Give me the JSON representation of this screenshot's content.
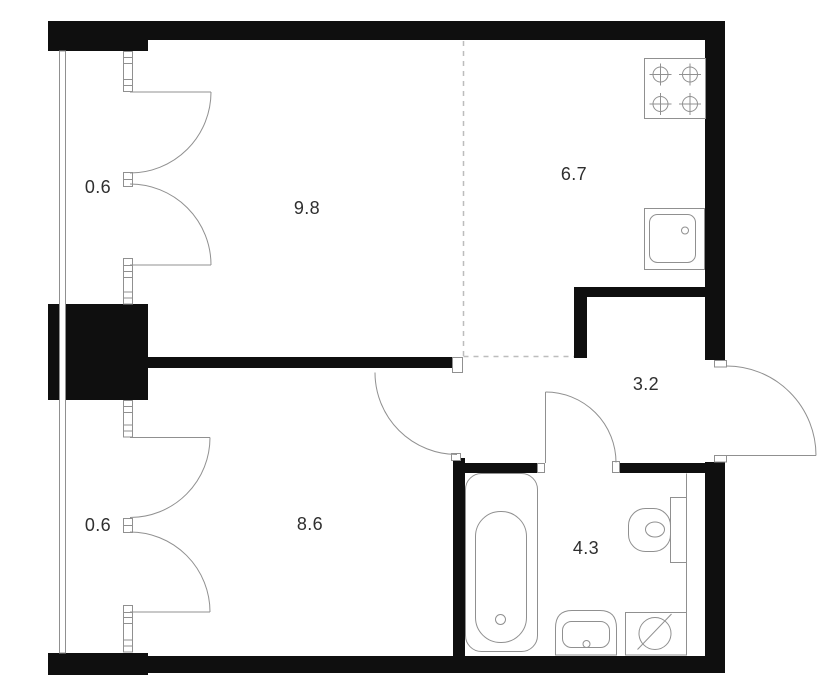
{
  "title": "Apartment floor plan",
  "colors": {
    "wall": "#0f0f0f",
    "line": "#909090",
    "dashed": "#bdbdbd",
    "label": "#2f2f2f",
    "background": "#ffffff"
  },
  "floorplan": {
    "type": "floor_plan",
    "rooms": [
      {
        "name": "living-room",
        "area": "9.8"
      },
      {
        "name": "kitchen",
        "area": "6.7"
      },
      {
        "name": "hallway",
        "area": "3.2"
      },
      {
        "name": "bedroom",
        "area": "8.6"
      },
      {
        "name": "bathroom",
        "area": "4.3"
      },
      {
        "name": "balcony-top",
        "area": "0.6"
      },
      {
        "name": "balcony-bottom",
        "area": "0.6"
      }
    ],
    "fixtures": [
      "stove-icon",
      "kitchen-sink-icon",
      "bathtub-icon",
      "toilet-icon",
      "bathroom-sink-icon",
      "washing-machine-icon"
    ]
  }
}
